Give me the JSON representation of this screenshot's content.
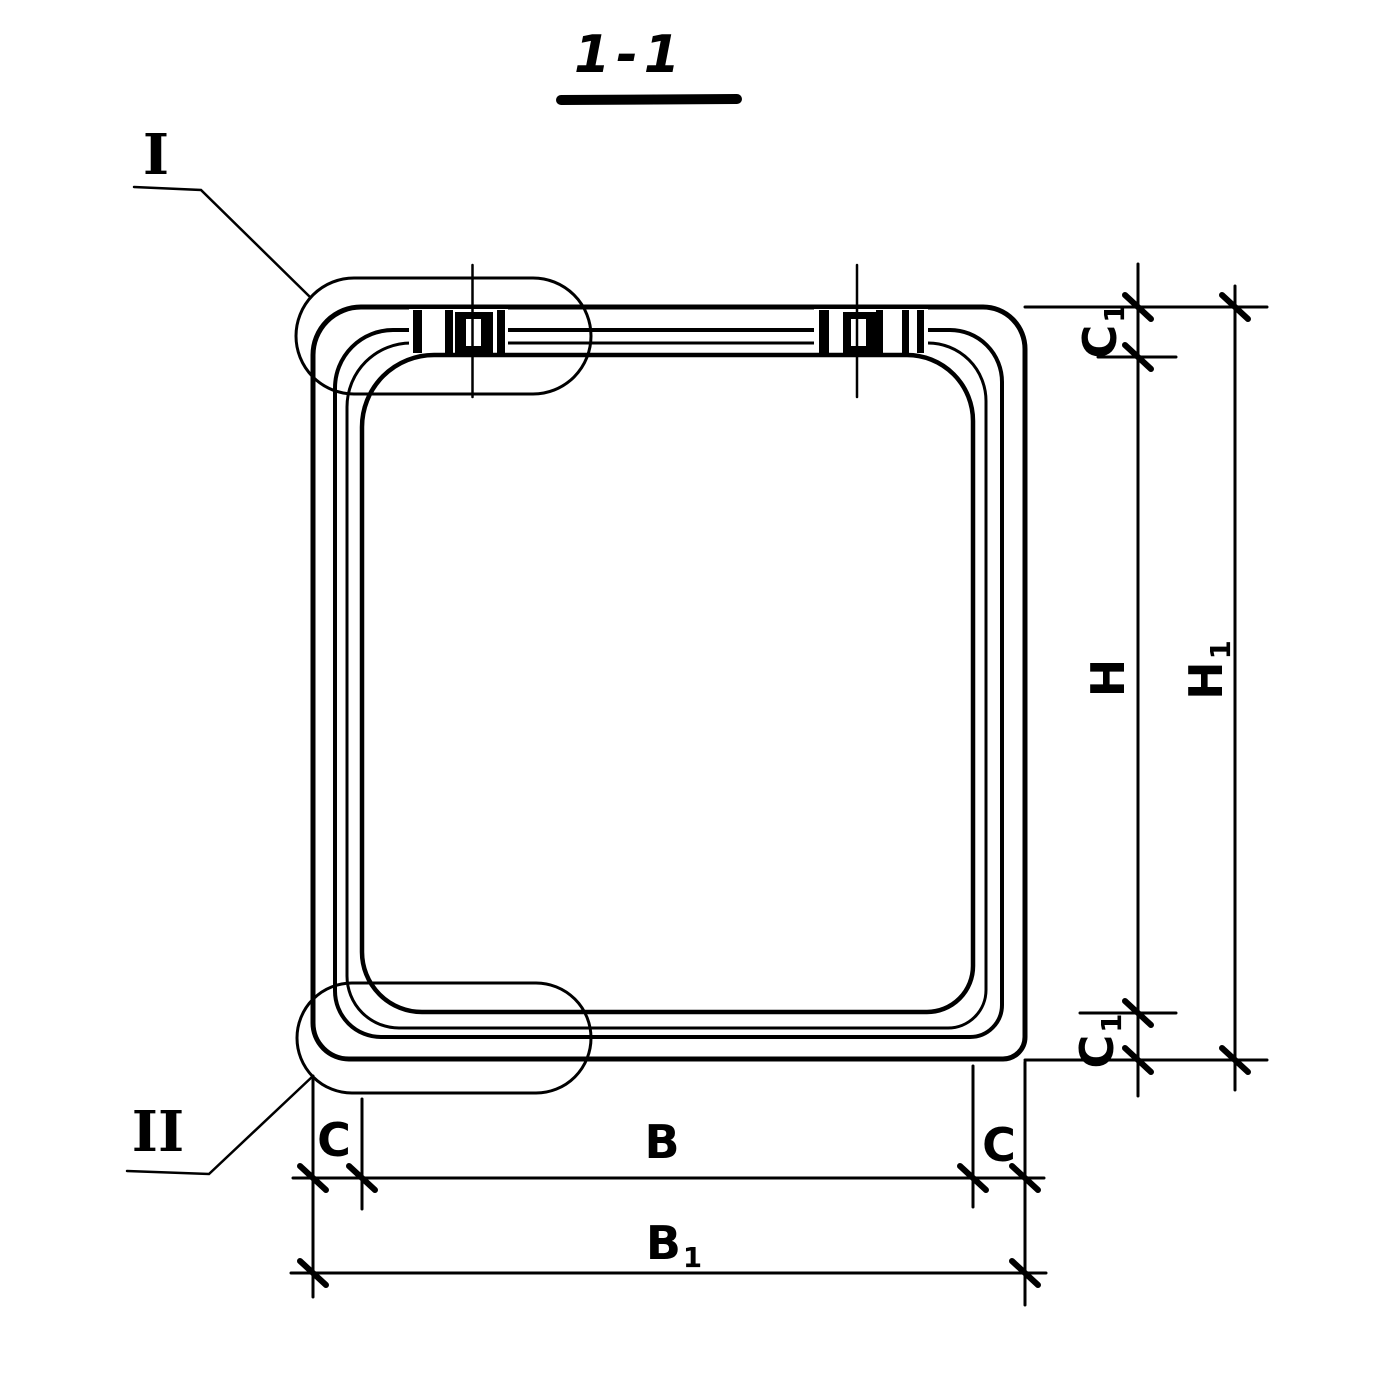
{
  "colors": {
    "ink": "#000000",
    "paper": "#ffffff"
  },
  "labels": {
    "title": "1-1",
    "detail_top": "I",
    "detail_bottom": "II",
    "c1_top_main": "C",
    "c1_top_sub": "1",
    "h_main": "H",
    "h1_main": "H",
    "h1_sub": "1",
    "c1_bottom_main": "C",
    "c1_bottom_sub": "1",
    "c_left": "C",
    "b_main": "B",
    "c_right": "C",
    "b1_main": "B",
    "b1_sub": "1"
  }
}
